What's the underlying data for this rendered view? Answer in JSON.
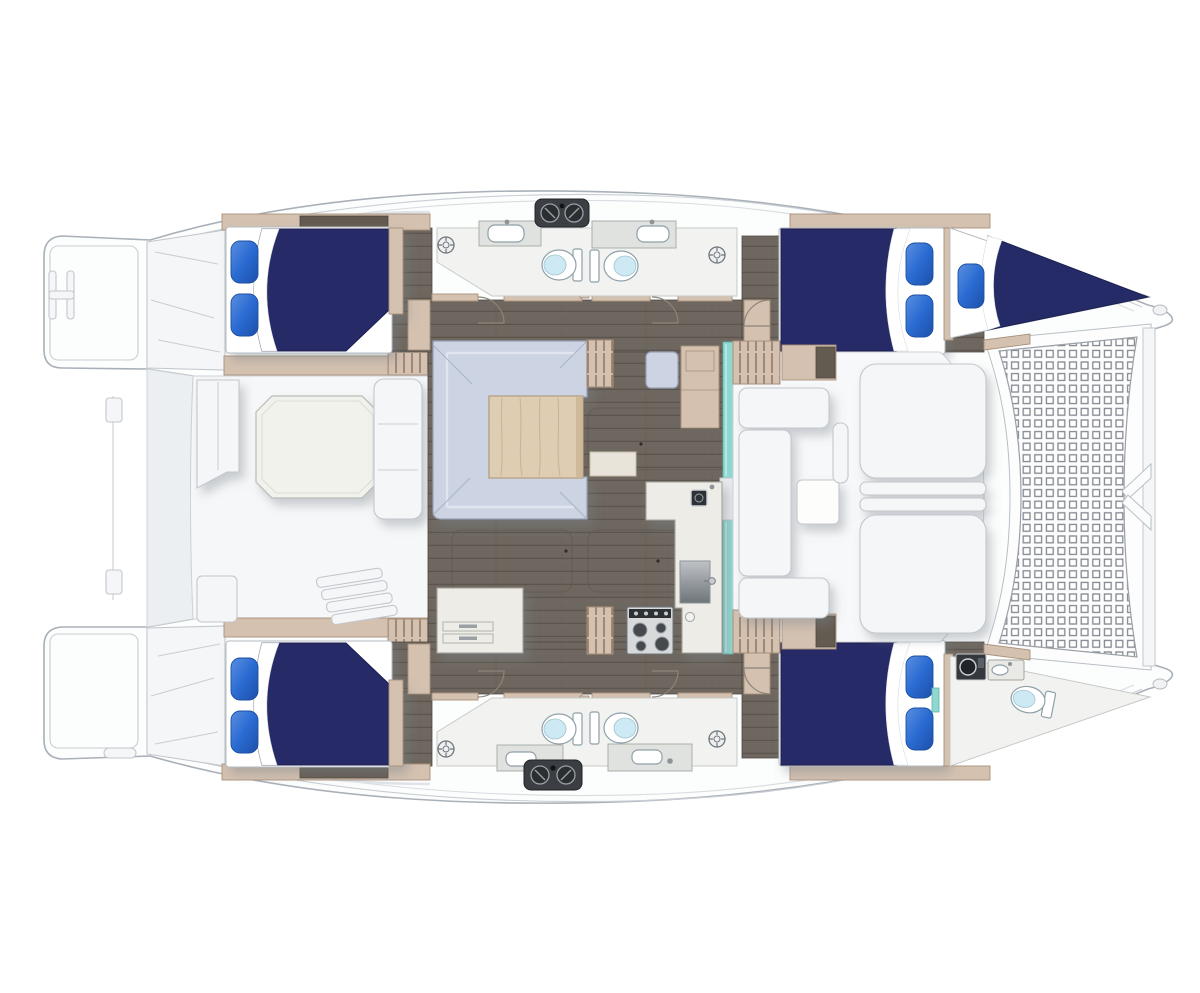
{
  "title": "Catamaran yacht accommodation floor plan (top-down)",
  "orientation": {
    "bow": "right",
    "stern": "left",
    "port": "top",
    "starboard": "bottom"
  },
  "labels": {
    "boat": "Catamaran hull outline",
    "trampoline": "Bow trampoline net",
    "bridle": "Forestay bridle chevron",
    "bow_crossbeam": "Bow crossbeam",
    "salon": "Salon with dinette and galley",
    "dinette": "U-shaped dinette sofa with table",
    "nav_station": "Navigation seat and cabinet",
    "galley": "Galley counter with stove, sink and fridge",
    "stove": "Four-burner stove",
    "aft_cockpit": "Aft cockpit with octagonal table",
    "forward_cockpit": "Forward cockpit lounge",
    "mast": "Mast post",
    "cabin_port_aft": "Port aft double cabin",
    "cabin_port_fwd": "Port forward double cabin",
    "bow_berth_port": "Port bow berth",
    "cabin_stbd_aft": "Starboard aft double cabin",
    "cabin_stbd_fwd": "Starboard forward double cabin",
    "head_port_aft": "Port aft head (WC)",
    "head_port_fwd": "Port forward head (WC)",
    "head_stbd_aft": "Starboard aft head (WC)",
    "head_stbd_fwd": "Starboard forward head (WC)",
    "head_bow_stbd": "Starboard bow en-suite head",
    "swim_platform_port": "Port swim platform with ladder",
    "swim_platform_stbd": "Starboard swim platform",
    "davits": "Dinghy davit rail",
    "winch_pod_port": "Port deck winch pod",
    "winch_pod_stbd": "Starboard deck winch pod",
    "companionway_port": "Port companionway steps",
    "companionway_stbd": "Starboard companionway steps"
  },
  "legend": {
    "cabins": 4,
    "double_berths": 5,
    "toilets": 5,
    "head_sinks": 5,
    "shower_drains": 4,
    "trampolines": 1
  },
  "colors": {
    "hull_fill": "#fcfdfd",
    "hull_stroke": "#a9b0b8",
    "deck_line": "#c9ced4",
    "white_furniture": "#f5f6f7",
    "furniture_stroke": "#c2c7cd",
    "navy": "#252b66",
    "navy_dark": "#1a1f4e",
    "pillow_hl": "#5b8fe0",
    "pillow": "#2a6bd2",
    "pillow_dark": "#1f4fa8",
    "wood_tan": "#d4c1b0",
    "wood_dark": "#645b50",
    "floor_brown": "#6e675f",
    "floor_seam": "#5b554d",
    "sofa": "#ccd3e2",
    "sofa_hl": "#e3e8f2",
    "table_wood": "#dfcdb3",
    "table_grain": "#c6ae8b",
    "counter": "#edece7",
    "counter_stroke": "#a3a39b",
    "equip_dark": "#3b3e42",
    "toilet_lid": "#cdeaf4",
    "teal": "#8fd8d2",
    "tramp_line": "#82888f",
    "shadow": "#7c838c"
  }
}
